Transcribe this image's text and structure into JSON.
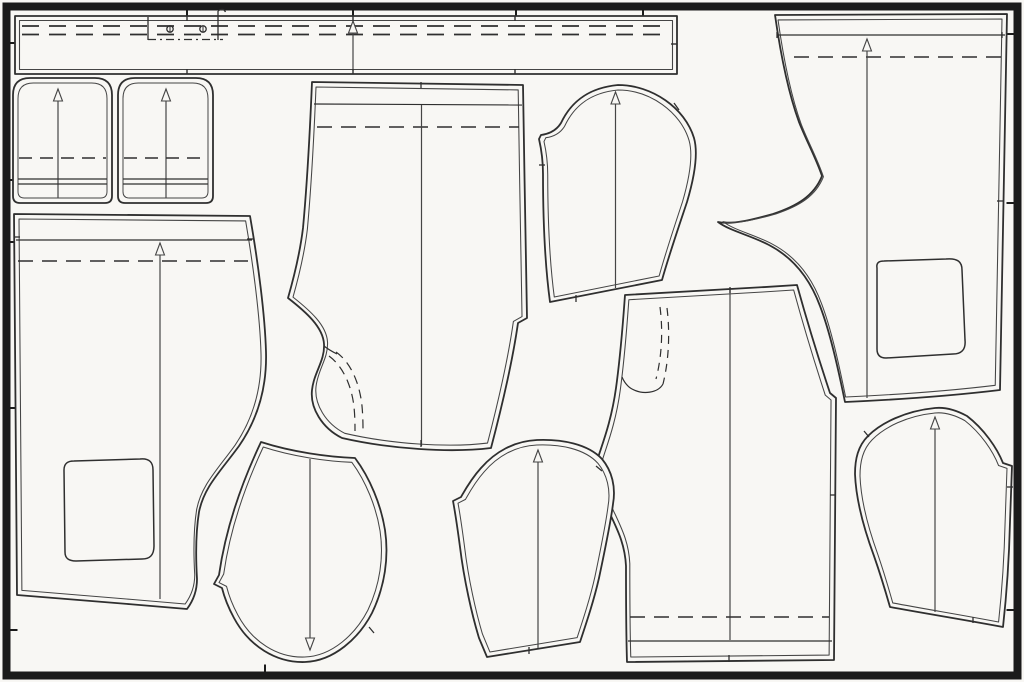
{
  "meta": {
    "title": "Sewing pattern marker layout with garment pattern pieces",
    "canvas_width": 1024,
    "canvas_height": 682
  },
  "style": {
    "background": "#f8f7f4",
    "piece_fill": "#f8f7f4",
    "frame_color": "#1b1b1b",
    "cut_color": "#2f2f2f",
    "sew_color": "#454545",
    "cut_width": 1.8,
    "sew_width": 1.1
  },
  "frame": {
    "x": 6.5,
    "y": 6.5,
    "width": 1011,
    "height": 669,
    "stroke_width": 8,
    "tick_length": 7,
    "ticks": [
      {
        "side": "top",
        "pos": 187
      },
      {
        "side": "top",
        "pos": 353
      },
      {
        "side": "top",
        "pos": 516
      },
      {
        "side": "top",
        "pos": 643
      },
      {
        "side": "left",
        "pos": 43
      },
      {
        "side": "left",
        "pos": 180
      },
      {
        "side": "left",
        "pos": 242
      },
      {
        "side": "left",
        "pos": 408
      },
      {
        "side": "left",
        "pos": 630
      },
      {
        "side": "right",
        "pos": 34
      },
      {
        "side": "right",
        "pos": 203
      },
      {
        "side": "right",
        "pos": 610
      },
      {
        "side": "bottom",
        "pos": 265
      }
    ]
  },
  "pieces": [
    {
      "name": "waistband",
      "outline": "M15,16 L677,16 L677,74 L15,74 Z",
      "inset": 4.5,
      "details": [
        {
          "type": "path",
          "name": "fold-line-dashed",
          "d": "M22,26 H670",
          "dash": "17 10",
          "w": 1.7
        },
        {
          "type": "path",
          "name": "fold-line-dashed",
          "d": "M22,34.5 H670",
          "dash": "17 10",
          "w": 1.7
        },
        {
          "type": "grainline",
          "x": 353,
          "y1": 21,
          "y2": 71,
          "arrow": "up"
        },
        {
          "type": "path",
          "name": "notch-tick",
          "d": "M187,16 v5",
          "w": 1.4
        },
        {
          "type": "path",
          "name": "notch-tick",
          "d": "M353,16 v5",
          "w": 1.4
        },
        {
          "type": "path",
          "name": "notch-tick",
          "d": "M515,16 v5",
          "w": 1.4
        },
        {
          "type": "path",
          "name": "notch-tick",
          "d": "M187,74 v-5",
          "w": 1.4
        },
        {
          "type": "path",
          "name": "notch-tick",
          "d": "M353,74 v-5",
          "w": 1.4
        },
        {
          "type": "path",
          "name": "notch-tick",
          "d": "M515,74 v-5",
          "w": 1.4
        },
        {
          "type": "path",
          "name": "notch-tick",
          "d": "M677,44 h-6",
          "w": 1.4
        },
        {
          "type": "path",
          "name": "fly-bracket",
          "d": "M148,17 V40",
          "w": 1.3
        },
        {
          "type": "path",
          "name": "fly-bracket",
          "d": "M218,11 V40",
          "w": 1.3
        },
        {
          "type": "path",
          "name": "fly-bracket",
          "d": "M218,11 C221,8.5 224,9 225.5,12",
          "w": 1.3
        },
        {
          "type": "path",
          "name": "fly-center-dashdot",
          "d": "M148,39.5 H223",
          "dash": "8 4 2 4",
          "w": 1.3
        },
        {
          "type": "circle",
          "name": "button-mark",
          "cx": 170,
          "cy": 29,
          "r": 3.2
        },
        {
          "type": "circle",
          "name": "button-mark",
          "cx": 203,
          "cy": 29,
          "r": 3.2
        },
        {
          "type": "path",
          "name": "buttonhole-slit",
          "d": "M170,26.5 v5",
          "w": 1
        },
        {
          "type": "path",
          "name": "buttonhole-slit",
          "d": "M203,26.5 v5",
          "w": 1
        }
      ]
    },
    {
      "name": "pocket-facing-left",
      "outline": "M13,95 Q13,78 30,78 L95,78 Q112,78 112,95 L112,196 Q112,203 105,203 L20,203 Q13,203 13,196 Z",
      "inset": 5,
      "details": [
        {
          "type": "grainline",
          "x": 58,
          "y1": 89,
          "y2": 198,
          "arrow": "up"
        },
        {
          "type": "path",
          "name": "fold-line-dashed",
          "d": "M19,158 H106",
          "dash": "13 8",
          "w": 1.5
        },
        {
          "type": "path",
          "name": "hem-line",
          "d": "M18,179 H107",
          "w": 1.2
        },
        {
          "type": "path",
          "name": "hem-line",
          "d": "M18,184 H107",
          "w": 1.2
        }
      ]
    },
    {
      "name": "pocket-facing-right",
      "outline": "M118,95 Q118,78 135,78 L196,78 Q213,78 213,95 L213,196 Q213,203 206,203 L125,203 Q118,203 118,196 Z",
      "inset": 5,
      "details": [
        {
          "type": "grainline",
          "x": 166,
          "y1": 89,
          "y2": 198,
          "arrow": "up"
        },
        {
          "type": "path",
          "name": "fold-line-dashed",
          "d": "M124,158 H207",
          "dash": "13 8",
          "w": 1.5
        },
        {
          "type": "path",
          "name": "hem-line",
          "d": "M123,179 H208",
          "w": 1.2
        },
        {
          "type": "path",
          "name": "hem-line",
          "d": "M123,184 H208",
          "w": 1.2
        }
      ]
    },
    {
      "name": "trouser-front-center",
      "outline": "M312,82 L523,85 C524,160 526,250 527,318 L518,323 C512,365 501,410 491,448 C450,453 390,449 342,438 C322,428 310,408 312,390 C314,372 325,361 324,344 C323,327 306,312 288,298 C294,277 300,253 303,228 C307,185 310,130 312,82 Z",
      "inset": 5,
      "details": [
        {
          "type": "path",
          "name": "waist-seam-line",
          "d": "M314,104 L522,105",
          "w": 1.2
        },
        {
          "type": "path",
          "name": "fold-line-dashed",
          "d": "M317,127 H519",
          "dash": "15 9",
          "w": 1.6
        },
        {
          "type": "grainline",
          "x": 421.5,
          "y1": 105,
          "y2": 446,
          "arrow": "none"
        },
        {
          "type": "path",
          "name": "notch-tick",
          "d": "M421,82 v6",
          "w": 1.3
        },
        {
          "type": "path",
          "name": "notch-tick",
          "d": "M421,440 v7",
          "w": 1.3
        },
        {
          "type": "path",
          "name": "pocket-bag-dashed",
          "d": "M336,352 C352,363 360,386 362,406 C363,417 363,425 363,431",
          "dash": "9 6",
          "w": 1.2
        },
        {
          "type": "path",
          "name": "pocket-bag-dashed",
          "d": "M329,356 C344,367 352,388 354,407 C355,417 355,425 355,431",
          "dash": "9 6",
          "w": 1.2
        },
        {
          "type": "path",
          "name": "pocket-curve",
          "d": "M324,346 C329,350 333,352 337,354",
          "w": 1.2
        }
      ]
    },
    {
      "name": "sleeve-top-center",
      "outline": "M618,85 C586,88 570,104 561,123 C556,131 549,134 541,135 L539,139 C542,152 543,162 543,174 C543,215 545,265 550,302 L662,280 C669,255 679,226 687,202 C695,175 698,152 694,138 C685,108 652,85 618,85 Z",
      "inset": 5,
      "details": [
        {
          "type": "grainline",
          "x": 615.5,
          "y1": 92,
          "y2": 288,
          "arrow": "up"
        },
        {
          "type": "path",
          "name": "notch-tick",
          "d": "M674,103 l5,7",
          "w": 1.3
        },
        {
          "type": "path",
          "name": "notch-tick",
          "d": "M539,165 h6",
          "w": 1.3
        },
        {
          "type": "path",
          "name": "notch-tick",
          "d": "M576,295 v7",
          "w": 1.3
        }
      ]
    },
    {
      "name": "trouser-back-right",
      "outline": "M775,15 L1007,14 C1005,145 1002,275 1000,390 C950,396 890,400 845,402 C838,368 830,332 820,306 C810,279 794,258 769,245 C750,235 730,231 718,222 C733,225 755,219 773,214 C797,206 814,196 822,176 C816,158 806,140 799,122 C788,92 780,50 775,15 Z",
      "inset": 5,
      "details": [
        {
          "type": "path",
          "name": "waist-seam-line",
          "d": "M777,35 H1005",
          "w": 1.2
        },
        {
          "type": "path",
          "name": "fold-line-dashed",
          "d": "M794,57 H1002",
          "dash": "15 9",
          "w": 1.6
        },
        {
          "type": "grainline",
          "x": 867,
          "y1": 39,
          "y2": 398,
          "arrow": "up"
        },
        {
          "type": "path",
          "name": "notch-tick",
          "d": "M777,32 v6",
          "w": 1.3
        },
        {
          "type": "path",
          "name": "notch-tick",
          "d": "M1002,32 v6",
          "w": 1.3
        },
        {
          "type": "path",
          "name": "notch-tick",
          "d": "M997,201 h7",
          "w": 1.3
        },
        {
          "type": "path",
          "name": "pocket-placement",
          "d": "M877,268 C876,262 880,261 884,261 L946,259 C958,258 962,262 962,270 L965,340 C966,350 961,354 953,354 L886,358 C879,358 877,354 877,349 Z",
          "w": 1.5
        }
      ]
    },
    {
      "name": "trouser-front-right",
      "outline": "M625,295 C668,293 735,289 797,285 C807,321 819,360 830,393 L836,398 C835,480 835,570 834,660 L627,662 C626,630 626,597 626,566 C625,545 618,531 611,516 C602,499 598,479 597,461 C601,447 611,424 616,388 C621,352 623,322 625,295 Z",
      "inset": 5,
      "details": [
        {
          "type": "grainline",
          "x": 730,
          "y1": 290,
          "y2": 640,
          "arrow": "none"
        },
        {
          "type": "path",
          "name": "notch-tick",
          "d": "M730,287 v6",
          "w": 1.3
        },
        {
          "type": "path",
          "name": "notch-tick",
          "d": "M729,655 v7",
          "w": 1.3
        },
        {
          "type": "path",
          "name": "notch-tick",
          "d": "M830,495 h6",
          "w": 1.3
        },
        {
          "type": "path",
          "name": "hem-dashed",
          "d": "M630,617 H829",
          "dash": "15 9",
          "w": 1.6
        },
        {
          "type": "path",
          "name": "hem-line",
          "d": "M628,641 H832",
          "w": 1.2
        },
        {
          "type": "path",
          "name": "pocket-bag-dashed",
          "d": "M667,308 C670,332 669,360 663,384",
          "dash": "8 6",
          "w": 1.2
        },
        {
          "type": "path",
          "name": "pocket-bag-dashed",
          "d": "M660,307 C663,330 662,356 656,379",
          "dash": "8 6",
          "w": 1.2
        },
        {
          "type": "path",
          "name": "pocket-curve",
          "d": "M663,384 C658,393 643,395 632,389 C628,387 624,382 622,377",
          "w": 1.2
        }
      ]
    },
    {
      "name": "trouser-back-left",
      "outline": "M14,214 L250,216 C258,262 265,315 266,352 C267,388 257,420 239,446 C220,472 204,487 199,512 C195,537 196,562 197,579 C197,592 193,601 187,609 C130,604 65,599 17,595 Z",
      "inset": 5,
      "details": [
        {
          "type": "path",
          "name": "waist-seam-line",
          "d": "M16,240 H252",
          "w": 1.2
        },
        {
          "type": "path",
          "name": "fold-line-dashed",
          "d": "M18,261 H248",
          "dash": "15 9",
          "w": 1.6
        },
        {
          "type": "grainline",
          "x": 160,
          "y1": 243,
          "y2": 599,
          "arrow": "up"
        },
        {
          "type": "path",
          "name": "notch-tick",
          "d": "M14,237 h6",
          "w": 1.3
        },
        {
          "type": "path",
          "name": "notch-tick",
          "d": "M247,239 h6",
          "w": 1.3
        },
        {
          "type": "path",
          "name": "pocket-placement",
          "d": "M64,470 C64,463 68,461 74,461 L140,459 C150,458 153,463 153,470 L154,546 C154,556 149,559 142,559 L76,561 C68,561 65,558 65,552 Z",
          "w": 1.5
        }
      ]
    },
    {
      "name": "pocket-bag",
      "outline": "M261,442 C292,452 328,457 355,458 C370,478 381,505 385,530 C389,557 385,586 372,613 C359,638 334,661 305,662 C276,663 249,646 234,618 C228,607 224,596 222,588 L214,584 L219,575 C226,526 243,480 261,442 Z",
      "inset": 5,
      "details": [
        {
          "type": "grainline",
          "x": 310,
          "y1": 459,
          "y2": 650,
          "arrow": "down"
        },
        {
          "type": "path",
          "name": "notch-tick",
          "d": "M369,627 l5,6",
          "w": 1.3
        }
      ]
    },
    {
      "name": "sleeve-bottom-center",
      "outline": "M537,440 C514,441 495,452 481,468 C471,479 465,490 461,497 L453,501 C456,517 458,532 460,547 C464,580 472,615 479,638 L487,657 C518,652 549,647 580,642 C587,621 594,600 599,578 C606,545 611,520 613,504 C616,487 612,471 602,459 C588,444 562,439 537,440 Z",
      "inset": 5,
      "details": [
        {
          "type": "grainline",
          "x": 538,
          "y1": 450,
          "y2": 648,
          "arrow": "up"
        },
        {
          "type": "path",
          "name": "notch-tick",
          "d": "M596,466 l6,5",
          "w": 1.3
        },
        {
          "type": "path",
          "name": "notch-tick",
          "d": "M529,647 v7",
          "w": 1.3
        }
      ]
    },
    {
      "name": "sleeve-bottom-right",
      "outline": "M935,408 C905,411 881,423 868,436 C858,446 855,459 855,474 C856,500 864,529 874,556 C881,576 886,593 890,607 C928,614 966,620 1003,627 C1006,600 1009,562 1010,522 L1012,466 L1003,463 C997,448 984,429 967,416 C956,410 945,407 935,408 Z",
      "inset": 5,
      "details": [
        {
          "type": "grainline",
          "x": 935,
          "y1": 417,
          "y2": 612,
          "arrow": "up"
        },
        {
          "type": "path",
          "name": "notch-tick",
          "d": "M864,431 l5,6",
          "w": 1.3
        },
        {
          "type": "path",
          "name": "notch-tick",
          "d": "M1007,487 h6",
          "w": 1.3
        },
        {
          "type": "path",
          "name": "notch-tick",
          "d": "M973,617 v6",
          "w": 1.3
        }
      ]
    }
  ]
}
